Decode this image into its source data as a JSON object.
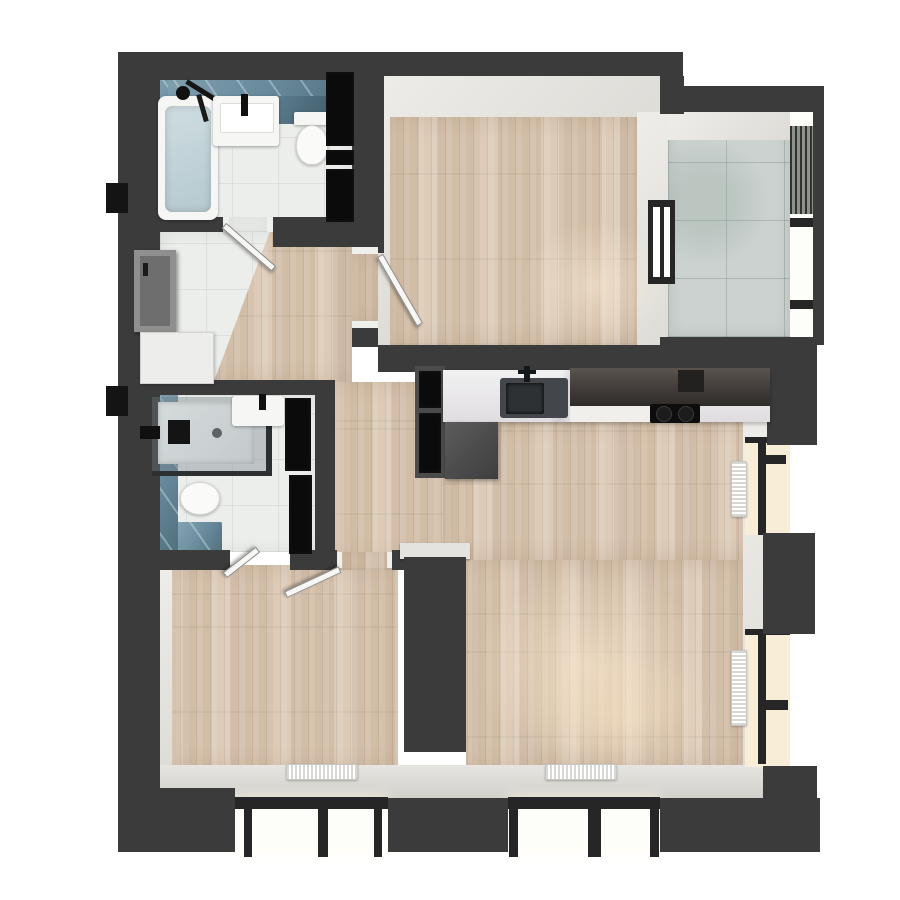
{
  "scene": {
    "kind": "apartment-floor-plan-3d-render",
    "view": "top-down",
    "background": "#ffffff"
  },
  "colors": {
    "wall": "#3b3b3b",
    "wood": "#d8c5b0",
    "tile_white": "#eceeec",
    "tile_blue": "#6d8fa1",
    "tile_gray": "#cbd2cf",
    "cabinet_black": "#0b0b0b",
    "counter_marble": "#eae8e9",
    "kitchen_dark": "#46413e",
    "glow_warm": "#f8eed8",
    "radiator": "#f5f5f3",
    "sill": "#dad9d5",
    "door_gray": "#8f8f8f"
  },
  "rooms": [
    {
      "id": "bathroom-main",
      "floor": "white-tile",
      "walls": "blue-tile",
      "fixtures": [
        "bathtub",
        "black-shower-column",
        "vanity-sink",
        "wall-hung-toilet",
        "black-storage-columns"
      ]
    },
    {
      "id": "bedroom-top",
      "floor": "wood-plank",
      "fixtures": [
        "door-to-hallway",
        "window-to-loggia"
      ]
    },
    {
      "id": "loggia-balcony",
      "floor": "gray-concrete-tile",
      "fixtures": [
        "glazed-facade",
        "louvered-panel"
      ]
    },
    {
      "id": "entry-hall",
      "floor": "white-tile",
      "fixtures": [
        "entrance-door",
        "shoe-cabinet"
      ]
    },
    {
      "id": "ensuite-bathroom",
      "floor": "white-tile",
      "walls": "blue-tile",
      "fixtures": [
        "walk-in-shower",
        "vanity-sink",
        "wall-hung-toilet",
        "black-storage-niches"
      ]
    },
    {
      "id": "kitchen",
      "floor": "wood-plank",
      "fixtures": [
        "marble-counter",
        "undermount-sink",
        "faucet",
        "dark-upper-cabinets",
        "cooktop-two-burners",
        "tall-black-cabinet"
      ]
    },
    {
      "id": "living-room",
      "floor": "wood-plank",
      "fixtures": [
        "radiator-bottom",
        "radiator-side-1",
        "radiator-side-2",
        "window-bay",
        "side-windows"
      ]
    },
    {
      "id": "bedroom-bottom",
      "floor": "wood-plank",
      "fixtures": [
        "radiator",
        "window-bay",
        "door-to-hall",
        "door-to-ensuite"
      ]
    }
  ],
  "counts": {
    "radiators": 4,
    "door-leaves": 4,
    "window-bays": 2,
    "side-windows": 2,
    "toilets": 2,
    "sinks": 3
  }
}
